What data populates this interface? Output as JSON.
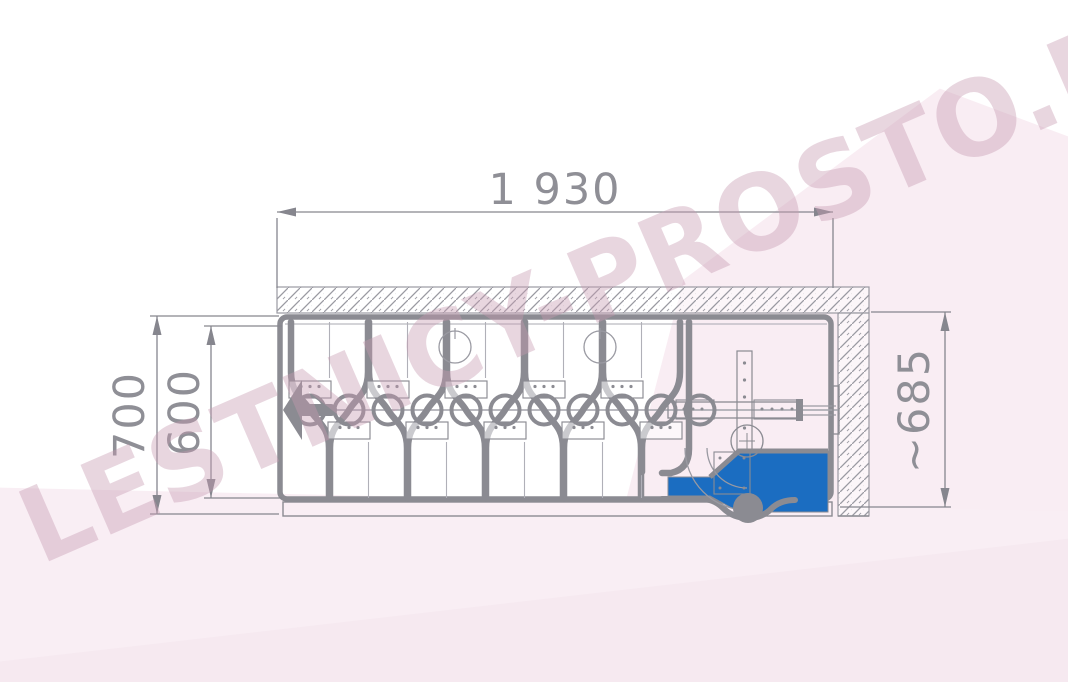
{
  "page": {
    "background_color": "#ffffff",
    "background_tint": "#f9edf3",
    "watermark": {
      "text": "LESTNICY-PROSTO.RU",
      "color": "#c79ab1"
    }
  },
  "diagram": {
    "type": "technical-drawing",
    "subject": "folded scissor attic ladder in ceiling opening, plan view",
    "dimensions": {
      "opening_width": {
        "value": "1 930"
      },
      "outer_height_left": {
        "value": "700"
      },
      "inner_height_left": {
        "value": "600"
      },
      "height_right": {
        "value": "~685"
      }
    },
    "colors": {
      "line_gray": "#8b8b92",
      "thin_line_gray": "#9a9aa2",
      "dim_text_gray": "#8f8f96",
      "highlight_blue": "#1b6dc1",
      "knob_gray": "#8b8b92"
    }
  }
}
